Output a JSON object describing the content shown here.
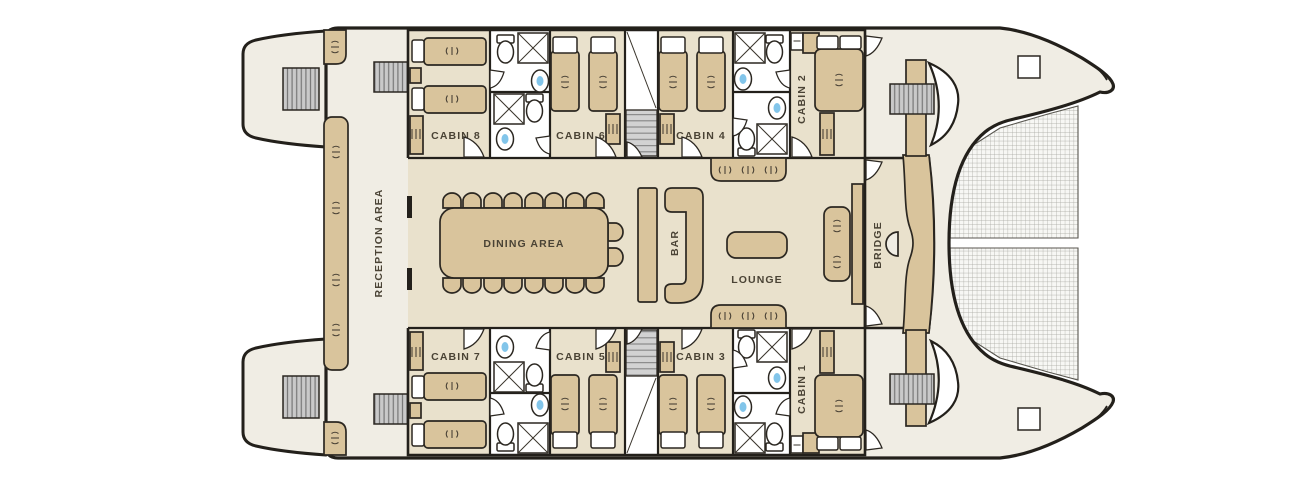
{
  "plan": {
    "rooms": {
      "reception": "RECEPTION AREA",
      "cabin8": "CABIN 8",
      "cabin6": "CABIN 6",
      "cabin4": "CABIN 4",
      "cabin2": "CABIN 2",
      "cabin7": "CABIN 7",
      "cabin5": "CABIN 5",
      "cabin3": "CABIN 3",
      "cabin1": "CABIN 1",
      "dining": "DINING AREA",
      "bar": "BAR",
      "lounge": "LOUNGE",
      "bridge": "BRIDGE"
    },
    "colors": {
      "deck": "#F0EDE4",
      "room": "#E9E1CC",
      "furniture": "#D9C49C",
      "wall": "#23201B",
      "sink_blue": "#82C5EA",
      "label_text": "#4A4335"
    }
  }
}
